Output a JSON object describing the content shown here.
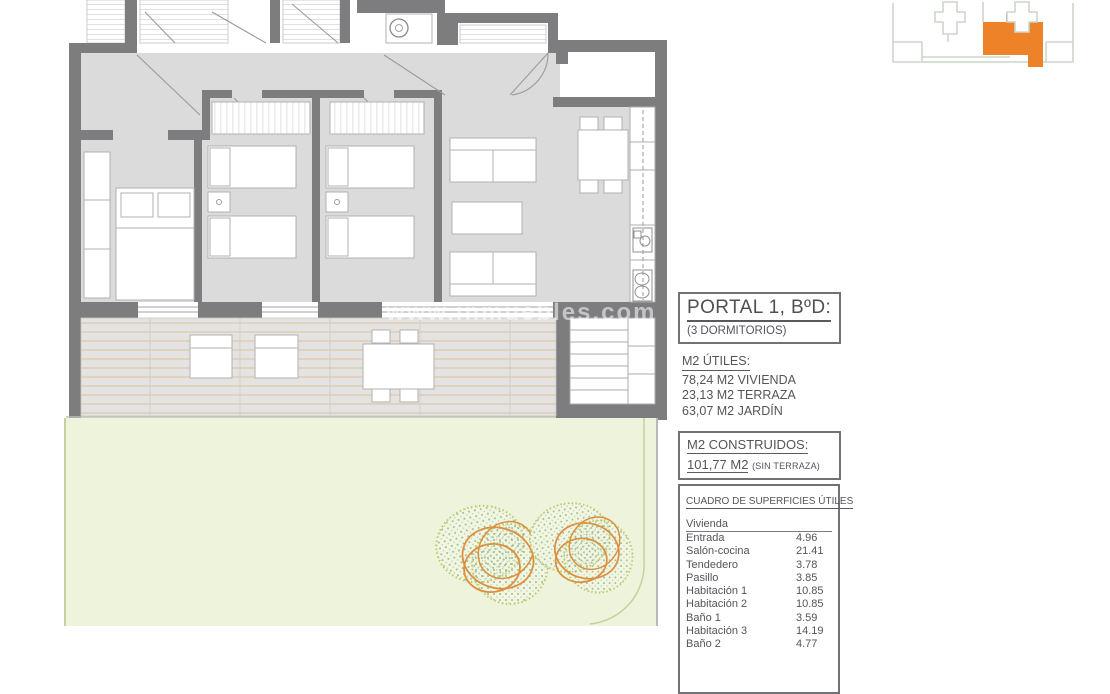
{
  "watermark": "www.inmuebles.com",
  "panel": {
    "portal": {
      "title": "PORTAL 1, BºD:",
      "subtitle": "(3 DORMITORIOS)"
    },
    "utiles": {
      "heading": "M2 ÚTILES:",
      "lines": [
        "78,24 M2 VIVIENDA",
        "23,13 M2 TERRAZA",
        "63,07 M2 JARDÍN"
      ]
    },
    "construidos": {
      "heading": "M2 CONSTRUIDOS:",
      "value": "101,77 M2",
      "note": "(SIN TERRAZA)"
    },
    "cuadro": {
      "heading": "CUADRO DE SUPERFICIES ÚTILES",
      "group": "Vivienda",
      "rows": [
        {
          "label": "Entrada",
          "value": "4.96"
        },
        {
          "label": "Salón-cocina",
          "value": "21.41"
        },
        {
          "label": "Tendedero",
          "value": "3.78"
        },
        {
          "label": "Pasillo",
          "value": "3.85"
        },
        {
          "label": "Habitación 1",
          "value": "10.85"
        },
        {
          "label": "Habitación 2",
          "value": "10.85"
        },
        {
          "label": "Baño 1",
          "value": "3.59"
        },
        {
          "label": "Habitación 3",
          "value": "14.19"
        },
        {
          "label": "Baño 2",
          "value": "4.77"
        }
      ]
    }
  },
  "keyplan": {
    "highlight_color": "#ee8229",
    "outline_color": "#cbd5cb"
  },
  "colors": {
    "wall": "#7d7d80",
    "floor": "#dbdbdc",
    "terrace_line": "#d8bc92",
    "garden": "#eef3db",
    "tree_orange": "#dc8f3e",
    "tree_green": "#bccb6a"
  }
}
